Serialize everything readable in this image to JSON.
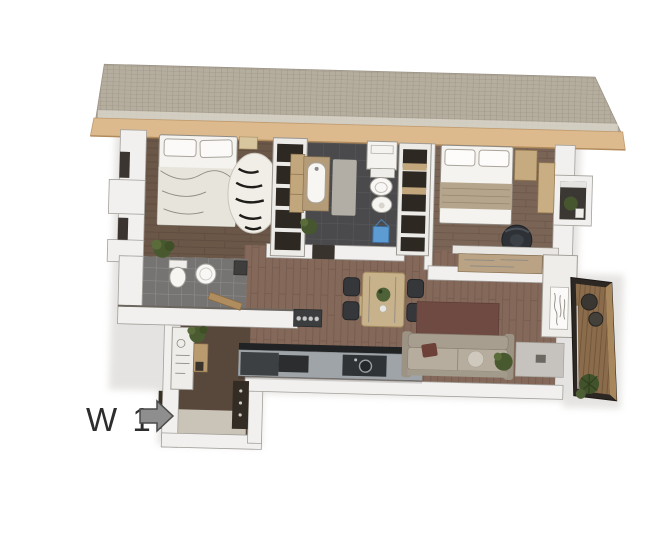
{
  "page": {
    "background": "#ffffff"
  },
  "annotation": {
    "unit_label": "W 1",
    "arrow_icon": "entrance-arrow-right"
  },
  "palette": {
    "roof_tiles": "#b5ad9e",
    "roof_grid": "#938c7d",
    "roof_fascia": "#dcba8e",
    "roof_fascia_edge": "#b18b5c",
    "wall": "#f1f0ee",
    "wall_stroke": "#a3a09b",
    "window_slit": "#3a3531",
    "bedroom1_floor": "#6b5748",
    "bedroom2_floor": "#7a6455",
    "living_floor": "#84695a",
    "bathroom1_tile": "#4a4a4c",
    "bathroom2_tile": "#767472",
    "entry_floor": "#cac3b7",
    "entry_shadow": "#58483b",
    "balcony_deck": "#8a6c4c",
    "balcony_frame": "#2c2722",
    "kitchen_counter": "#9ea4a8",
    "appliance_dark": "#2b2d2f",
    "dining_table": "#c8b28c",
    "chair_dark": "#35373a",
    "sofa": "#b6ad9e",
    "living_rug": "#6f4a42",
    "bed_linen": "#f5f3ef",
    "blanket_tan": "#b5a58c",
    "wood_shelf": "#c3a77c",
    "plant_green": "#49592f",
    "bucket_blue": "#5d9bd3",
    "label_text": "#2d2d2d",
    "arrow_fill": "#8e8e8e",
    "arrow_stroke": "#4a4a4a"
  },
  "plan": {
    "elements": [
      "roof",
      "bedroom-1",
      "central-bathroom",
      "closet-corridor",
      "bedroom-2",
      "second-bathroom",
      "entry-hall",
      "living-dining-kitchen",
      "balcony"
    ]
  }
}
